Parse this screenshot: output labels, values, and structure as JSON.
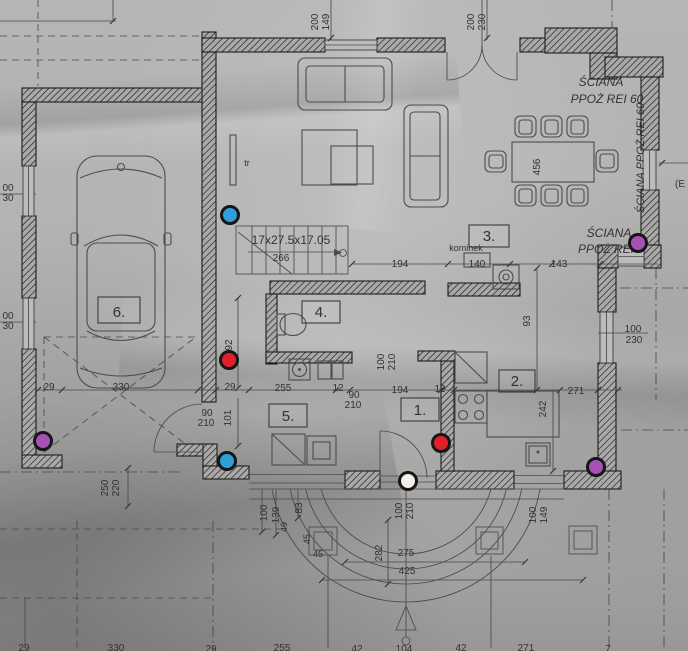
{
  "colors": {
    "paper": "#b2b1af",
    "ink": "#3a3a3a",
    "dot_ring": "#161616",
    "dot_blue": "#2e9fd9",
    "dot_red": "#e2202c",
    "dot_purple": "#a851b5",
    "dot_white": "#f3efeb"
  },
  "plan": {
    "room_labels": [
      {
        "number": "6.",
        "x": 98,
        "y": 297,
        "w": 42,
        "h": 26
      },
      {
        "number": "5.",
        "x": 269,
        "y": 404,
        "w": 38,
        "h": 23
      },
      {
        "number": "4.",
        "x": 302,
        "y": 301,
        "w": 38,
        "h": 22
      },
      {
        "number": "3.",
        "x": 469,
        "y": 225,
        "w": 40,
        "h": 22
      },
      {
        "number": "1.",
        "x": 401,
        "y": 398,
        "w": 38,
        "h": 23
      },
      {
        "number": "2.",
        "x": 499,
        "y": 370,
        "w": 36,
        "h": 22
      }
    ],
    "text_labels": [
      {
        "t": "200",
        "x": 318,
        "y": 22,
        "r": -90,
        "fs": 10
      },
      {
        "t": "149",
        "x": 329,
        "y": 22,
        "r": -90,
        "fs": 10
      },
      {
        "t": "200",
        "x": 474,
        "y": 22,
        "r": -90,
        "fs": 10
      },
      {
        "t": "230",
        "x": 485,
        "y": 22,
        "r": -90,
        "fs": 10
      },
      {
        "t": "ŚCIANA",
        "x": 601,
        "y": 86,
        "fs": 12,
        "it": 1
      },
      {
        "t": "PPOŻ REI 60",
        "x": 607,
        "y": 103,
        "fs": 12,
        "it": 1
      },
      {
        "t": "ŚCIANA PPOŻ REI 60",
        "x": 644,
        "y": 158,
        "r": -90,
        "fs": 11,
        "it": 1
      },
      {
        "t": "ŚCIANA",
        "x": 609,
        "y": 237,
        "fs": 12,
        "it": 1
      },
      {
        "t": "PPOŻ REI",
        "x": 606,
        "y": 253,
        "fs": 12,
        "it": 1
      },
      {
        "t": "(E",
        "x": 680,
        "y": 187,
        "fs": 10
      },
      {
        "t": "456",
        "x": 540,
        "y": 167,
        "r": -90,
        "fs": 10
      },
      {
        "t": "tr",
        "x": 247,
        "y": 166,
        "fs": 9
      },
      {
        "t": "17x27.5x17.05",
        "x": 291,
        "y": 244,
        "fs": 12
      },
      {
        "t": "266",
        "x": 281,
        "y": 261,
        "fs": 10
      },
      {
        "t": "kominek",
        "x": 466,
        "y": 251,
        "fs": 9
      },
      {
        "t": "194",
        "x": 400,
        "y": 267,
        "fs": 10
      },
      {
        "t": "140",
        "x": 477,
        "y": 267,
        "fs": 10
      },
      {
        "t": "143",
        "x": 559,
        "y": 267,
        "fs": 10
      },
      {
        "t": "93",
        "x": 530,
        "y": 321,
        "r": -90,
        "fs": 10
      },
      {
        "t": "100",
        "x": 633,
        "y": 332,
        "fs": 10
      },
      {
        "t": "230",
        "x": 634,
        "y": 343,
        "fs": 10
      },
      {
        "t": "271",
        "x": 576,
        "y": 394,
        "fs": 10
      },
      {
        "t": "242",
        "x": 546,
        "y": 409,
        "r": -90,
        "fs": 10
      },
      {
        "t": "92",
        "x": 232,
        "y": 345,
        "r": -90,
        "fs": 10
      },
      {
        "t": "29",
        "x": 49,
        "y": 390,
        "fs": 10
      },
      {
        "t": "330",
        "x": 121,
        "y": 390,
        "fs": 10
      },
      {
        "t": "29",
        "x": 230,
        "y": 390,
        "fs": 10
      },
      {
        "t": "255",
        "x": 283,
        "y": 391,
        "fs": 10
      },
      {
        "t": "12",
        "x": 338,
        "y": 391,
        "fs": 10
      },
      {
        "t": "194",
        "x": 400,
        "y": 393,
        "fs": 10
      },
      {
        "t": "12",
        "x": 440,
        "y": 392,
        "fs": 10
      },
      {
        "t": "90",
        "x": 354,
        "y": 398,
        "fs": 10
      },
      {
        "t": "210",
        "x": 353,
        "y": 408,
        "fs": 10
      },
      {
        "t": "90",
        "x": 207,
        "y": 416,
        "fs": 10
      },
      {
        "t": "210",
        "x": 206,
        "y": 426,
        "fs": 10
      },
      {
        "t": "101",
        "x": 231,
        "y": 418,
        "r": -90,
        "fs": 10
      },
      {
        "t": "100",
        "x": 384,
        "y": 362,
        "r": -90,
        "fs": 10
      },
      {
        "t": "210",
        "x": 395,
        "y": 362,
        "r": -90,
        "fs": 10
      },
      {
        "t": "100",
        "x": 402,
        "y": 511,
        "r": -90,
        "fs": 10
      },
      {
        "t": "210",
        "x": 413,
        "y": 511,
        "r": -90,
        "fs": 10
      },
      {
        "t": "100",
        "x": 536,
        "y": 515,
        "r": -90,
        "fs": 10
      },
      {
        "t": "149",
        "x": 547,
        "y": 515,
        "r": -90,
        "fs": 10
      },
      {
        "t": "100",
        "x": 267,
        "y": 513,
        "r": -90,
        "fs": 10
      },
      {
        "t": "139",
        "x": 279,
        "y": 515,
        "r": -90,
        "fs": 10
      },
      {
        "t": "49",
        "x": 287,
        "y": 527,
        "r": -90,
        "fs": 9
      },
      {
        "t": "83",
        "x": 302,
        "y": 508,
        "r": -90,
        "fs": 10
      },
      {
        "t": "45",
        "x": 310,
        "y": 539,
        "r": -90,
        "fs": 9
      },
      {
        "t": "45",
        "x": 318,
        "y": 557,
        "fs": 9
      },
      {
        "t": "250",
        "x": 108,
        "y": 488,
        "r": -90,
        "fs": 10
      },
      {
        "t": "220",
        "x": 119,
        "y": 488,
        "r": -90,
        "fs": 10
      },
      {
        "t": "282",
        "x": 382,
        "y": 553,
        "r": -90,
        "fs": 10
      },
      {
        "t": "275",
        "x": 406,
        "y": 556,
        "fs": 10
      },
      {
        "t": "425",
        "x": 407,
        "y": 574,
        "fs": 10
      },
      {
        "t": "29",
        "x": 24,
        "y": 651,
        "fs": 10
      },
      {
        "t": "330",
        "x": 116,
        "y": 651,
        "fs": 10
      },
      {
        "t": "29",
        "x": 211,
        "y": 652,
        "fs": 10
      },
      {
        "t": "255",
        "x": 282,
        "y": 651,
        "fs": 10
      },
      {
        "t": "42",
        "x": 357,
        "y": 652,
        "fs": 10
      },
      {
        "t": "104",
        "x": 404,
        "y": 652,
        "fs": 10
      },
      {
        "t": "42",
        "x": 461,
        "y": 651,
        "fs": 10
      },
      {
        "t": "271",
        "x": 526,
        "y": 651,
        "fs": 10
      },
      {
        "t": "7",
        "x": 608,
        "y": 652,
        "fs": 10
      },
      {
        "t": "00",
        "x": 8,
        "y": 191,
        "fs": 10
      },
      {
        "t": "30",
        "x": 8,
        "y": 201,
        "fs": 10
      },
      {
        "t": "00",
        "x": 8,
        "y": 319,
        "fs": 10
      },
      {
        "t": "30",
        "x": 8,
        "y": 329,
        "fs": 10
      }
    ],
    "dots": [
      {
        "name": "dot-blue-1",
        "color": "#2e9fd9",
        "x": 230,
        "y": 215
      },
      {
        "name": "dot-purple-1",
        "color": "#a851b5",
        "x": 638,
        "y": 243
      },
      {
        "name": "dot-red-1",
        "color": "#e2202c",
        "x": 229,
        "y": 360
      },
      {
        "name": "dot-purple-2",
        "color": "#a851b5",
        "x": 43,
        "y": 441
      },
      {
        "name": "dot-blue-2",
        "color": "#2e9fd9",
        "x": 227,
        "y": 461
      },
      {
        "name": "dot-red-2",
        "color": "#e2202c",
        "x": 441,
        "y": 443
      },
      {
        "name": "dot-white-1",
        "color": "#f3efeb",
        "x": 408,
        "y": 481
      },
      {
        "name": "dot-purple-3",
        "color": "#a851b5",
        "x": 596,
        "y": 467
      }
    ]
  }
}
